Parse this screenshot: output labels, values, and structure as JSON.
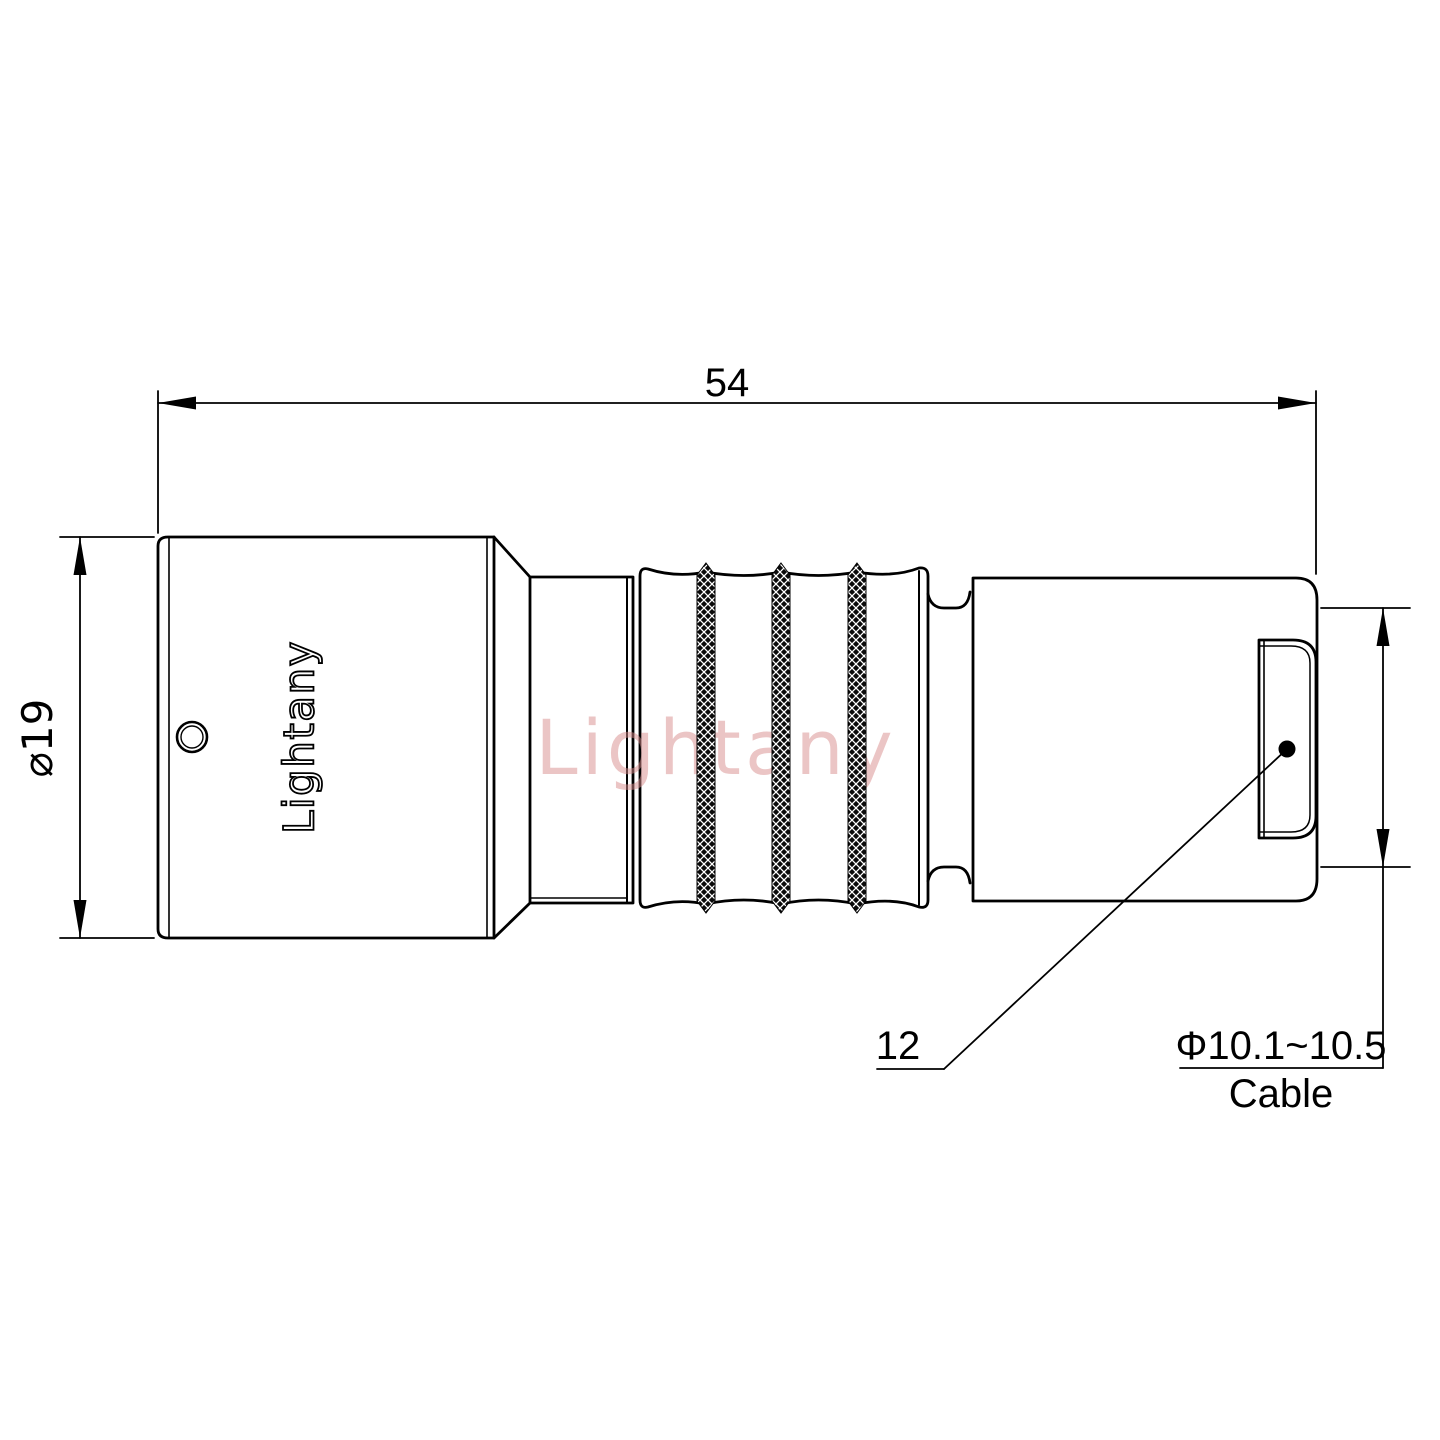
{
  "drawing": {
    "type": "technical-drawing-connector-side-view",
    "brand_logo": "Lightany",
    "watermark": "Lightany",
    "labels": {
      "overall_length": "54",
      "body_diameter": "⌀19",
      "leader_ref": "12",
      "cable_range": "Φ10.1~10.5",
      "cable_word": "Cable"
    },
    "colors": {
      "line": "#000000",
      "watermark": "#d98c8c",
      "background": "#ffffff"
    }
  }
}
